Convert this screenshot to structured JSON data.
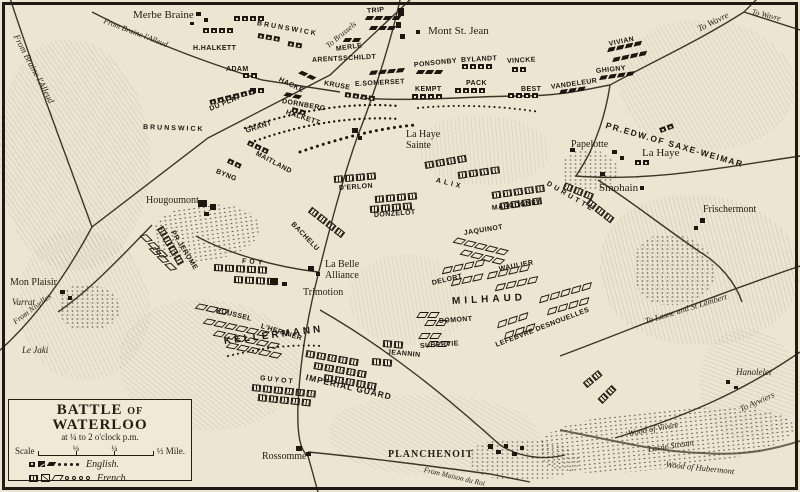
{
  "legend_box": {
    "title_1": "BATTLE",
    "title_of": "OF",
    "title_2": "WATERLOO",
    "subtitle": "at ¼ to 2 o'clock p.m.",
    "scale_label": "Scale",
    "scale_ticks": [
      "⅛",
      "¼"
    ],
    "scale_end": "½ Mile.",
    "legend": [
      {
        "side": "english",
        "label": "English."
      },
      {
        "side": "french",
        "label": "French."
      }
    ]
  },
  "colors": {
    "paper": "#ece5d1",
    "ink": "#221d15",
    "road": "#3c352a"
  },
  "towns": [
    {
      "name": "Merbe Braine",
      "x": 133,
      "y": 10,
      "s": 11,
      "cls": ""
    },
    {
      "name": "Mont St. Jean",
      "x": 428,
      "y": 26,
      "s": 11,
      "cls": ""
    },
    {
      "name": "Papelotte",
      "x": 571,
      "y": 140,
      "s": 10,
      "cls": ""
    },
    {
      "name": "La Haye",
      "x": 642,
      "y": 148,
      "s": 11,
      "cls": ""
    },
    {
      "name": "Smohain",
      "x": 599,
      "y": 183,
      "s": 11,
      "cls": ""
    },
    {
      "name": "Frischermont",
      "x": 703,
      "y": 205,
      "s": 10,
      "cls": ""
    },
    {
      "name": "Hougoumont",
      "x": 146,
      "y": 196,
      "s": 10,
      "cls": ""
    },
    {
      "name": "La Haye\nSainte",
      "x": 406,
      "y": 130,
      "s": 10,
      "cls": ""
    },
    {
      "name": "La Belle\nAlliance",
      "x": 325,
      "y": 260,
      "s": 10,
      "cls": ""
    },
    {
      "name": "Trimotion",
      "x": 303,
      "y": 288,
      "s": 10,
      "cls": ""
    },
    {
      "name": "Mon Plaisir",
      "x": 10,
      "y": 278,
      "s": 10,
      "cls": ""
    },
    {
      "name": "Varrat",
      "x": 12,
      "y": 298,
      "s": 9,
      "cls": "it"
    },
    {
      "name": "Le Jaki",
      "x": 22,
      "y": 346,
      "s": 9,
      "cls": "it"
    },
    {
      "name": "Rossomme",
      "x": 262,
      "y": 452,
      "s": 10,
      "cls": ""
    },
    {
      "name": "PLANCHENOIT",
      "x": 388,
      "y": 450,
      "s": 10,
      "cls": "caps"
    },
    {
      "name": "Hanolelet",
      "x": 736,
      "y": 368,
      "s": 9,
      "cls": "it"
    }
  ],
  "road_labels": [
    {
      "text": "From Braine l'Alleud",
      "x": 16,
      "y": 30,
      "rot": 62,
      "s": 9
    },
    {
      "text": "From Braine l'Alleud",
      "x": 104,
      "y": 16,
      "rot": 21,
      "s": 8
    },
    {
      "text": "To Brussels",
      "x": 327,
      "y": 42,
      "rot": -40,
      "s": 8
    },
    {
      "text": "To Wavre",
      "x": 698,
      "y": 24,
      "rot": -26,
      "s": 9
    },
    {
      "text": "To Wavre",
      "x": 752,
      "y": 7,
      "rot": 14,
      "s": 8
    },
    {
      "text": "To Lasne and St Lambert",
      "x": 645,
      "y": 316,
      "rot": -17,
      "s": 8.5
    },
    {
      "text": "To Aywiers",
      "x": 740,
      "y": 404,
      "rot": -24,
      "s": 8.5
    },
    {
      "text": "From Nivelles",
      "x": 14,
      "y": 318,
      "rot": -37,
      "s": 8
    },
    {
      "text": "From Maison du Roi",
      "x": 424,
      "y": 465,
      "rot": 13,
      "s": 7.5
    },
    {
      "text": "Lasne Stream",
      "x": 648,
      "y": 444,
      "rot": -9,
      "s": 8.5
    },
    {
      "text": "Wood of Vivere",
      "x": 628,
      "y": 428,
      "rot": -10,
      "s": 8.5
    },
    {
      "text": "Wood of Hubermont",
      "x": 666,
      "y": 459,
      "rot": 6,
      "s": 8.5
    }
  ],
  "units": {
    "english": [
      {
        "name": "H.HALKETT",
        "x": 193,
        "y": 45,
        "rot": 0
      },
      {
        "name": "ADAM",
        "x": 226,
        "y": 66,
        "rot": 0
      },
      {
        "name": "DU PLAT",
        "x": 210,
        "y": 106,
        "rot": -22
      },
      {
        "name": "BRUNSWICK",
        "x": 257,
        "y": 20,
        "rot": 10,
        "ls": 2
      },
      {
        "name": "BRUNSWICK",
        "x": 143,
        "y": 124,
        "rot": 2,
        "ls": 2
      },
      {
        "name": "GRANT",
        "x": 246,
        "y": 128,
        "rot": -18
      },
      {
        "name": "MAITLAND",
        "x": 256,
        "y": 150,
        "rot": 28
      },
      {
        "name": "BYNG",
        "x": 216,
        "y": 168,
        "rot": 22
      },
      {
        "name": "HALKETT",
        "x": 286,
        "y": 109,
        "rot": 18
      },
      {
        "name": "HACKE",
        "x": 279,
        "y": 76,
        "rot": 26
      },
      {
        "name": "KRUSE",
        "x": 324,
        "y": 80,
        "rot": 10
      },
      {
        "name": "DORNBERG",
        "x": 282,
        "y": 98,
        "rot": 10
      },
      {
        "name": "ARENTSSCHILDT",
        "x": 312,
        "y": 57,
        "rot": -3
      },
      {
        "name": "MERLE",
        "x": 336,
        "y": 46,
        "rot": -8
      },
      {
        "name": "TRIP",
        "x": 367,
        "y": 8,
        "rot": -5
      },
      {
        "name": "E.SOMERSET",
        "x": 355,
        "y": 81,
        "rot": -3
      },
      {
        "name": "PONSONBY",
        "x": 414,
        "y": 62,
        "rot": -6
      },
      {
        "name": "BYLANDT",
        "x": 461,
        "y": 57,
        "rot": -3
      },
      {
        "name": "VINCKE",
        "x": 507,
        "y": 58,
        "rot": -3
      },
      {
        "name": "PACK",
        "x": 466,
        "y": 80,
        "rot": 0
      },
      {
        "name": "KEMPT",
        "x": 415,
        "y": 86,
        "rot": 0
      },
      {
        "name": "BEST",
        "x": 521,
        "y": 86,
        "rot": 0
      },
      {
        "name": "VANDELEUR",
        "x": 551,
        "y": 84,
        "rot": -8
      },
      {
        "name": "GHIGNY",
        "x": 596,
        "y": 68,
        "rot": -6
      },
      {
        "name": "VIVIAN",
        "x": 609,
        "y": 41,
        "rot": -12
      },
      {
        "name": "PR.EDW.OF SAXE-WEIMAR",
        "x": 606,
        "y": 120,
        "rot": 16,
        "s": 8.5,
        "ls": 1.5
      }
    ],
    "french": [
      {
        "name": "D'ERLON",
        "x": 339,
        "y": 185,
        "rot": -4
      },
      {
        "name": "ALIX",
        "x": 436,
        "y": 177,
        "rot": 14,
        "ls": 3
      },
      {
        "name": "DONZELOT",
        "x": 374,
        "y": 212,
        "rot": -4
      },
      {
        "name": "MARCOGNET",
        "x": 492,
        "y": 205,
        "rot": -7
      },
      {
        "name": "DURUTTE",
        "x": 547,
        "y": 180,
        "rot": 30,
        "ls": 3
      },
      {
        "name": "JAQUINOT",
        "x": 464,
        "y": 230,
        "rot": -9
      },
      {
        "name": "BACHELU",
        "x": 292,
        "y": 220,
        "rot": 46
      },
      {
        "name": "PR.JEROME",
        "x": 172,
        "y": 228,
        "rot": 58
      },
      {
        "name": "FOY",
        "x": 242,
        "y": 258,
        "rot": 4,
        "ls": 3
      },
      {
        "name": "ROUSSEL",
        "x": 216,
        "y": 307,
        "rot": 14
      },
      {
        "name": "L'HERITIER",
        "x": 261,
        "y": 323,
        "rot": 17
      },
      {
        "name": "KELLERMANN",
        "x": 224,
        "y": 336,
        "rot": -7,
        "s": 10,
        "ls": 3
      },
      {
        "name": "GUYOT",
        "x": 260,
        "y": 375,
        "rot": 6,
        "ls": 2
      },
      {
        "name": "IMPERIAL GUARD",
        "x": 306,
        "y": 372,
        "rot": 13,
        "s": 8.5,
        "ls": 1
      },
      {
        "name": "JEANNIN",
        "x": 387,
        "y": 349,
        "rot": 5
      },
      {
        "name": "MILHAUD",
        "x": 452,
        "y": 296,
        "rot": -3,
        "s": 10,
        "ls": 4
      },
      {
        "name": "DELORT",
        "x": 432,
        "y": 280,
        "rot": -13
      },
      {
        "name": "DOMONT",
        "x": 439,
        "y": 318,
        "rot": -4
      },
      {
        "name": "SUBERVIE",
        "x": 420,
        "y": 343,
        "rot": -4
      },
      {
        "name": "WAULIER",
        "x": 499,
        "y": 266,
        "rot": -11
      },
      {
        "name": "LEFEBVRE DESNOUELLES",
        "x": 496,
        "y": 342,
        "rot": -21
      }
    ]
  },
  "clusters": [
    {
      "side": "en",
      "arm": "inf",
      "n": 4,
      "x": 203,
      "y": 28,
      "rot": 0
    },
    {
      "side": "en",
      "arm": "inf",
      "n": 4,
      "x": 234,
      "y": 16,
      "rot": 0
    },
    {
      "side": "en",
      "arm": "inf",
      "n": 2,
      "x": 243,
      "y": 73,
      "rot": 0
    },
    {
      "side": "en",
      "arm": "inf",
      "n": 2,
      "x": 250,
      "y": 88,
      "rot": 0
    },
    {
      "side": "en",
      "arm": "inf",
      "n": 6,
      "x": 210,
      "y": 100,
      "rot": -14
    },
    {
      "side": "en",
      "arm": "inf",
      "n": 3,
      "x": 258,
      "y": 33,
      "rot": 10
    },
    {
      "side": "en",
      "arm": "inf",
      "n": 2,
      "x": 288,
      "y": 41,
      "rot": 10
    },
    {
      "side": "en",
      "arm": "inf",
      "n": 3,
      "x": 248,
      "y": 140,
      "rot": 25
    },
    {
      "side": "en",
      "arm": "inf",
      "n": 2,
      "x": 228,
      "y": 158,
      "rot": 25
    },
    {
      "side": "en",
      "arm": "inf",
      "n": 4,
      "x": 345,
      "y": 92,
      "rot": 8
    },
    {
      "side": "en",
      "arm": "inf",
      "n": 2,
      "x": 292,
      "y": 107,
      "rot": 15
    },
    {
      "side": "en",
      "arm": "inf",
      "n": 4,
      "x": 462,
      "y": 64,
      "rot": 0
    },
    {
      "side": "en",
      "arm": "inf",
      "n": 4,
      "x": 455,
      "y": 88,
      "rot": 0
    },
    {
      "side": "en",
      "arm": "inf",
      "n": 4,
      "x": 412,
      "y": 94,
      "rot": 0
    },
    {
      "side": "en",
      "arm": "inf",
      "n": 4,
      "x": 508,
      "y": 93,
      "rot": 0
    },
    {
      "side": "en",
      "arm": "inf",
      "n": 2,
      "x": 512,
      "y": 67,
      "rot": 0
    },
    {
      "side": "en",
      "arm": "inf",
      "n": 2,
      "x": 660,
      "y": 128,
      "rot": -20
    },
    {
      "side": "en",
      "arm": "inf",
      "n": 2,
      "x": 635,
      "y": 160,
      "rot": 0
    },
    {
      "side": "en",
      "arm": "cav",
      "n": 4,
      "x": 366,
      "y": 16,
      "rot": 0
    },
    {
      "side": "en",
      "arm": "cav",
      "n": 3,
      "x": 370,
      "y": 26,
      "rot": 0
    },
    {
      "side": "en",
      "arm": "cav",
      "n": 4,
      "x": 370,
      "y": 71,
      "rot": -5
    },
    {
      "side": "en",
      "arm": "cav",
      "n": 3,
      "x": 417,
      "y": 70,
      "rot": 0
    },
    {
      "side": "en",
      "arm": "cav",
      "n": 2,
      "x": 344,
      "y": 38,
      "rot": 0
    },
    {
      "side": "en",
      "arm": "cav",
      "n": 3,
      "x": 560,
      "y": 90,
      "rot": -8
    },
    {
      "side": "en",
      "arm": "cav",
      "n": 4,
      "x": 608,
      "y": 48,
      "rot": -12
    },
    {
      "side": "en",
      "arm": "cav",
      "n": 4,
      "x": 613,
      "y": 58,
      "rot": -12
    },
    {
      "side": "en",
      "arm": "cav",
      "n": 4,
      "x": 600,
      "y": 76,
      "rot": -8
    },
    {
      "side": "en",
      "arm": "cav",
      "n": 2,
      "x": 300,
      "y": 70,
      "rot": 25
    },
    {
      "side": "en",
      "arm": "cav",
      "n": 2,
      "x": 285,
      "y": 92,
      "rot": 12
    },
    {
      "side": "fr",
      "arm": "inf",
      "n": 4,
      "x": 334,
      "y": 176,
      "rot": -5
    },
    {
      "side": "fr",
      "arm": "inf",
      "n": 4,
      "x": 375,
      "y": 196,
      "rot": -5
    },
    {
      "side": "fr",
      "arm": "inf",
      "n": 4,
      "x": 370,
      "y": 206,
      "rot": -5
    },
    {
      "side": "fr",
      "arm": "inf",
      "n": 4,
      "x": 425,
      "y": 162,
      "rot": -10
    },
    {
      "side": "fr",
      "arm": "inf",
      "n": 4,
      "x": 458,
      "y": 172,
      "rot": -8
    },
    {
      "side": "fr",
      "arm": "inf",
      "n": 5,
      "x": 492,
      "y": 192,
      "rot": -8
    },
    {
      "side": "fr",
      "arm": "inf",
      "n": 4,
      "x": 500,
      "y": 203,
      "rot": -8
    },
    {
      "side": "fr",
      "arm": "inf",
      "n": 3,
      "x": 564,
      "y": 182,
      "rot": 22
    },
    {
      "side": "fr",
      "arm": "inf",
      "n": 3,
      "x": 588,
      "y": 198,
      "rot": 38
    },
    {
      "side": "fr",
      "arm": "inf",
      "n": 4,
      "x": 310,
      "y": 206,
      "rot": 38
    },
    {
      "side": "fr",
      "arm": "inf",
      "n": 4,
      "x": 160,
      "y": 224,
      "rot": 60
    },
    {
      "side": "fr",
      "arm": "inf",
      "n": 5,
      "x": 214,
      "y": 264,
      "rot": 3
    },
    {
      "side": "fr",
      "arm": "inf",
      "n": 4,
      "x": 234,
      "y": 276,
      "rot": 3
    },
    {
      "side": "fr",
      "arm": "inf",
      "n": 6,
      "x": 252,
      "y": 384,
      "rot": 6
    },
    {
      "side": "fr",
      "arm": "inf",
      "n": 5,
      "x": 258,
      "y": 394,
      "rot": 6
    },
    {
      "side": "fr",
      "arm": "inf",
      "n": 5,
      "x": 306,
      "y": 350,
      "rot": 10
    },
    {
      "side": "fr",
      "arm": "inf",
      "n": 5,
      "x": 314,
      "y": 362,
      "rot": 10
    },
    {
      "side": "fr",
      "arm": "inf",
      "n": 5,
      "x": 324,
      "y": 374,
      "rot": 10
    },
    {
      "side": "fr",
      "arm": "inf",
      "n": 2,
      "x": 383,
      "y": 340,
      "rot": 5
    },
    {
      "side": "fr",
      "arm": "inf",
      "n": 2,
      "x": 372,
      "y": 358,
      "rot": 5
    },
    {
      "side": "fr",
      "arm": "inf",
      "n": 2,
      "x": 585,
      "y": 382,
      "rot": -40
    },
    {
      "side": "fr",
      "arm": "inf",
      "n": 2,
      "x": 600,
      "y": 398,
      "rot": -45
    },
    {
      "side": "fr",
      "arm": "cav",
      "n": 5,
      "x": 455,
      "y": 237,
      "rot": 14
    },
    {
      "side": "fr",
      "arm": "cav",
      "n": 4,
      "x": 462,
      "y": 249,
      "rot": 14
    },
    {
      "side": "fr",
      "arm": "cav",
      "n": 4,
      "x": 488,
      "y": 273,
      "rot": -12
    },
    {
      "side": "fr",
      "arm": "cav",
      "n": 4,
      "x": 496,
      "y": 285,
      "rot": -12
    },
    {
      "side": "fr",
      "arm": "cav",
      "n": 5,
      "x": 540,
      "y": 297,
      "rot": -16
    },
    {
      "side": "fr",
      "arm": "cav",
      "n": 4,
      "x": 548,
      "y": 309,
      "rot": -16
    },
    {
      "side": "fr",
      "arm": "cav",
      "n": 4,
      "x": 443,
      "y": 268,
      "rot": -12
    },
    {
      "side": "fr",
      "arm": "cav",
      "n": 3,
      "x": 452,
      "y": 280,
      "rot": -12
    },
    {
      "side": "fr",
      "arm": "cav",
      "n": 2,
      "x": 418,
      "y": 312,
      "rot": 0
    },
    {
      "side": "fr",
      "arm": "cav",
      "n": 2,
      "x": 426,
      "y": 320,
      "rot": 0
    },
    {
      "side": "fr",
      "arm": "cav",
      "n": 2,
      "x": 420,
      "y": 333,
      "rot": 0
    },
    {
      "side": "fr",
      "arm": "cav",
      "n": 2,
      "x": 428,
      "y": 341,
      "rot": 0
    },
    {
      "side": "fr",
      "arm": "cav",
      "n": 3,
      "x": 498,
      "y": 322,
      "rot": -18
    },
    {
      "side": "fr",
      "arm": "cav",
      "n": 3,
      "x": 505,
      "y": 333,
      "rot": -18
    },
    {
      "side": "fr",
      "arm": "cav",
      "n": 6,
      "x": 205,
      "y": 318,
      "rot": 12
    },
    {
      "side": "fr",
      "arm": "cav",
      "n": 6,
      "x": 215,
      "y": 330,
      "rot": 12
    },
    {
      "side": "fr",
      "arm": "cav",
      "n": 5,
      "x": 228,
      "y": 342,
      "rot": 12
    },
    {
      "side": "fr",
      "arm": "cav",
      "n": 3,
      "x": 197,
      "y": 303,
      "rot": 12
    },
    {
      "side": "fr",
      "arm": "cav",
      "n": 3,
      "x": 143,
      "y": 232,
      "rot": 45
    },
    {
      "side": "fr",
      "arm": "cav",
      "n": 3,
      "x": 152,
      "y": 245,
      "rot": 45
    }
  ]
}
